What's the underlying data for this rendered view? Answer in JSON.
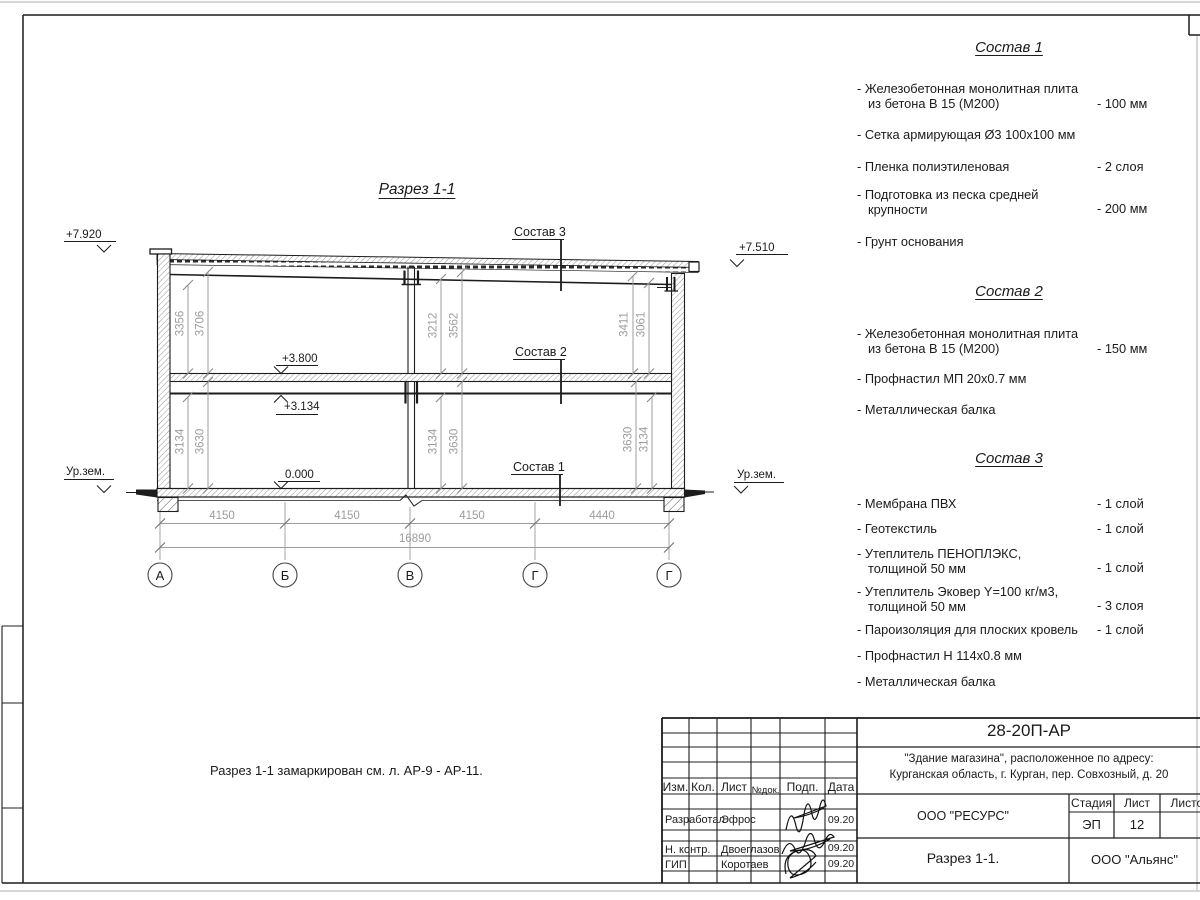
{
  "section": {
    "title": "Разрез 1-1",
    "note": "Разрез 1-1 замаркирован см. л. АР-9 - АР-11.",
    "elevations": {
      "roof_left": "+7.920",
      "roof_right": "+7.510",
      "floor2": "+3.800",
      "beam": "+3.134",
      "zero": "0.000",
      "ground": "Ур.зем."
    },
    "v_dims": [
      "3356",
      "3706",
      "3212",
      "3562",
      "3411",
      "3061",
      "3134",
      "3630",
      "3134",
      "3630",
      "3630",
      "3134"
    ],
    "h_dims": [
      "4150",
      "4150",
      "4150",
      "4440"
    ],
    "total_dim": "16890",
    "axes": [
      "А",
      "Б",
      "В",
      "Г",
      "Г"
    ]
  },
  "compositions": [
    {
      "title": "Состав 1",
      "items": [
        {
          "lines": [
            "- Железобетонная  монолитная плита",
            "из бетона В 15 (М200)"
          ],
          "value": "- 100 мм"
        },
        {
          "lines": [
            "- Сетка армирующая Ø3 100х100 мм"
          ],
          "value": ""
        },
        {
          "lines": [
            "- Пленка полиэтиленовая"
          ],
          "value": "-  2 слоя"
        },
        {
          "lines": [
            "- Подготовка из песка средней",
            "крупности"
          ],
          "value": "- 200 мм"
        },
        {
          "lines": [
            "- Грунт основания"
          ],
          "value": ""
        }
      ]
    },
    {
      "title": "Состав 2",
      "items": [
        {
          "lines": [
            "- Железобетонная  монолитная плита",
            "из бетона В 15 (М200)"
          ],
          "value": "- 150 мм"
        },
        {
          "lines": [
            "- Профнастил МП 20х0.7 мм"
          ],
          "value": ""
        },
        {
          "lines": [
            "- Металлическая балка"
          ],
          "value": ""
        }
      ]
    },
    {
      "title": "Состав 3",
      "items": [
        {
          "lines": [
            "- Мембрана ПВХ"
          ],
          "value": "- 1 слой"
        },
        {
          "lines": [
            "- Геотекстиль"
          ],
          "value": "- 1 слой"
        },
        {
          "lines": [
            "- Утеплитель ПЕНОПЛЭКС,",
            "толщиной 50 мм"
          ],
          "value": "- 1 слой"
        },
        {
          "lines": [
            "- Утеплитель Эковер Y=100 кг/м3,",
            "толщиной 50 мм"
          ],
          "value": "- 3 слоя"
        },
        {
          "lines": [
            "- Пароизоляция для плоских кровель"
          ],
          "value": "- 1 слой"
        },
        {
          "lines": [
            "- Профнастил Н 114х0.8 мм"
          ],
          "value": ""
        },
        {
          "lines": [
            "- Металлическая балка"
          ],
          "value": ""
        }
      ]
    }
  ],
  "titleblock": {
    "doc_number": "28-20П-АР",
    "object_line1": "\"Здание магазина\", расположенное по адресу:",
    "object_line2": "Курганская область, г. Курган, пер. Совхозный, д. 20",
    "cols": {
      "izm": "Изм.",
      "kol": "Кол.",
      "list": "Лист",
      "ndok": "№док.",
      "podp": "Подп.",
      "data": "Дата"
    },
    "rows": [
      {
        "role": "Разработал",
        "name": "Эфрос",
        "date": "09.20"
      },
      {
        "role": "Н. контр.",
        "name": "Двоеглазов",
        "date": "09.20"
      },
      {
        "role": "ГИП",
        "name": "Коротаев",
        "date": "09.20"
      }
    ],
    "company": "ООО \"РЕСУРС\"",
    "stage_label": "Стадия",
    "sheet_label": "Лист",
    "sheets_label": "Листов",
    "stage": "ЭП",
    "sheet": "12",
    "drawing_name": "Разрез 1-1.",
    "contractor": "ООО \"Альянс\""
  }
}
